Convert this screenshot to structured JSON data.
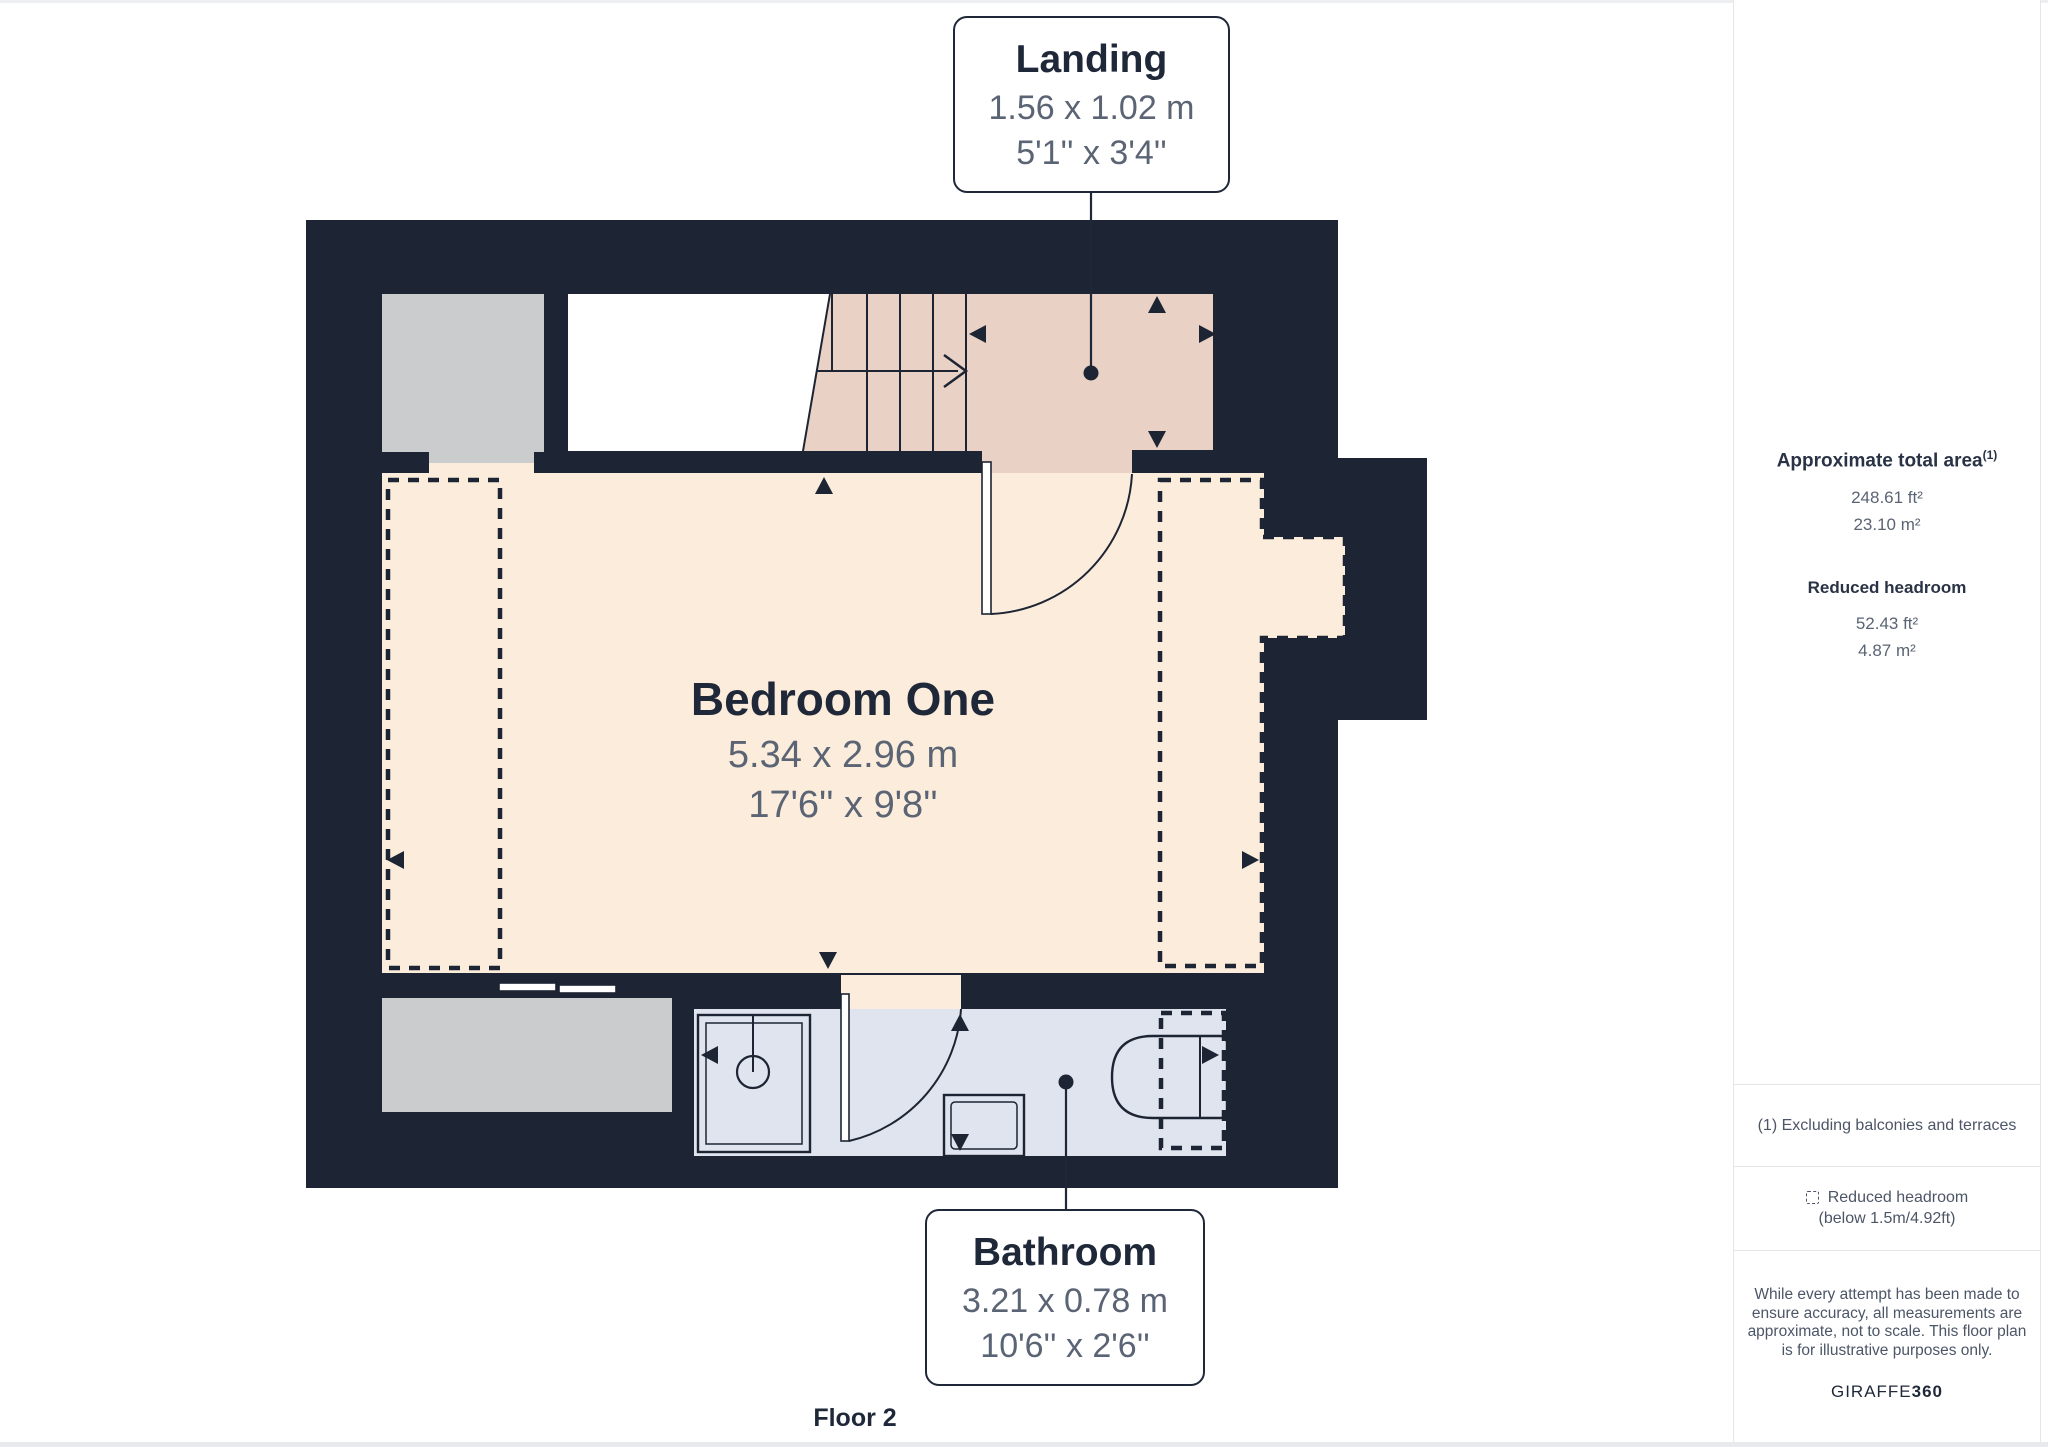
{
  "rooms": {
    "landing": {
      "name": "Landing",
      "metric": "1.56 x 1.02 m",
      "imperial": "5'1'' x 3'4''"
    },
    "bedroom": {
      "name": "Bedroom One",
      "metric": "5.34 x 2.96 m",
      "imperial": "17'6'' x 9'8''"
    },
    "bathroom": {
      "name": "Bathroom",
      "metric": "3.21 x 0.78 m",
      "imperial": "10'6'' x 2'6''"
    }
  },
  "floor_label": "Floor 2",
  "sidebar": {
    "total_area": {
      "heading": "Approximate total area",
      "superscript": "(1)",
      "ft": "248.61 ft²",
      "m": "23.10 m²"
    },
    "reduced_headroom": {
      "heading": "Reduced headroom",
      "ft": "52.43 ft²",
      "m": "4.87 m²"
    },
    "footnote": "(1) Excluding balconies and terraces",
    "legend": {
      "icon": "dashed-square-icon",
      "line1": "Reduced headroom",
      "line2": "(below 1.5m/4.92ft)"
    },
    "disclaimer": "While every attempt has been made to ensure accuracy, all measurements are approximate, not to scale. This floor plan is for illustrative purposes only.",
    "brand": {
      "name": "GIRAFFE",
      "suffix": "360"
    }
  },
  "colors": {
    "wall": "#1d2433",
    "bedroom_floor": "#fcecdb",
    "landing_floor": "#e9d1c5",
    "bathroom_floor": "#dfe4ee",
    "storage_gray": "#cbcccd",
    "label_ink": "#1f2839",
    "dimension_text": "#5a6474",
    "divider": "#e4e6ea"
  }
}
